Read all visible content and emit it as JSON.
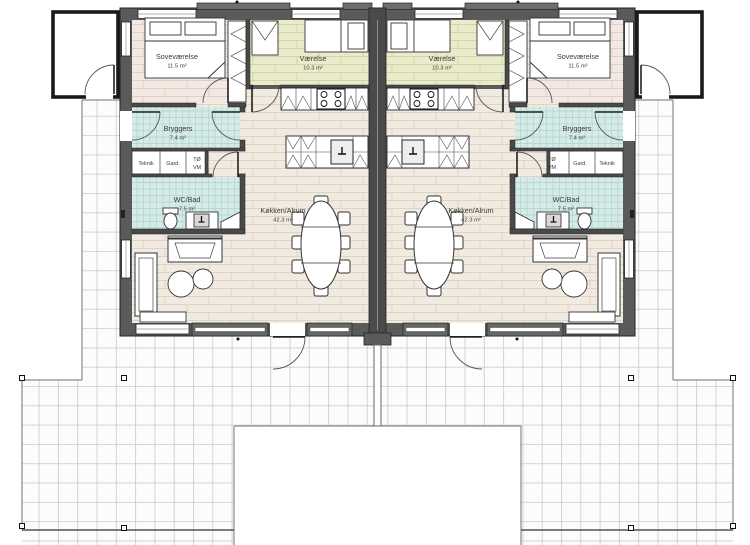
{
  "plan": {
    "type": "architectural-floor-plan",
    "units": 2,
    "mirrored": true
  },
  "rooms": {
    "sovevaerelse": {
      "name": "Soveværelse",
      "area": "11.5 m²"
    },
    "vaerelse": {
      "name": "Værelse",
      "area": "10.3 m²"
    },
    "bryggers": {
      "name": "Bryggers",
      "area": "7.4 m²"
    },
    "wc_bad": {
      "name": "WC/Bad",
      "area": "7.5 m²"
    },
    "kokken_alrum": {
      "name": "Køkken/Alrum",
      "area": "42.3 m²"
    },
    "teknik": {
      "label": "Teknik"
    },
    "garderobe": {
      "label": "Gard."
    },
    "toerretumbler": {
      "label": "TØ"
    },
    "vaskemaskine": {
      "label": "VM"
    }
  },
  "colors": {
    "wall": "#5a5a5a",
    "internal_wall": "#4a4a4a",
    "bedroom_floor": "#f3e8e2",
    "room_floor_green": "#e9ebca",
    "living_floor": "#f1eae1",
    "wet_room_tile": "#d6eae7",
    "terrace_tile": "#fcfcfc",
    "terrace_grid": "#c9c9c9",
    "outline": "#222222"
  }
}
